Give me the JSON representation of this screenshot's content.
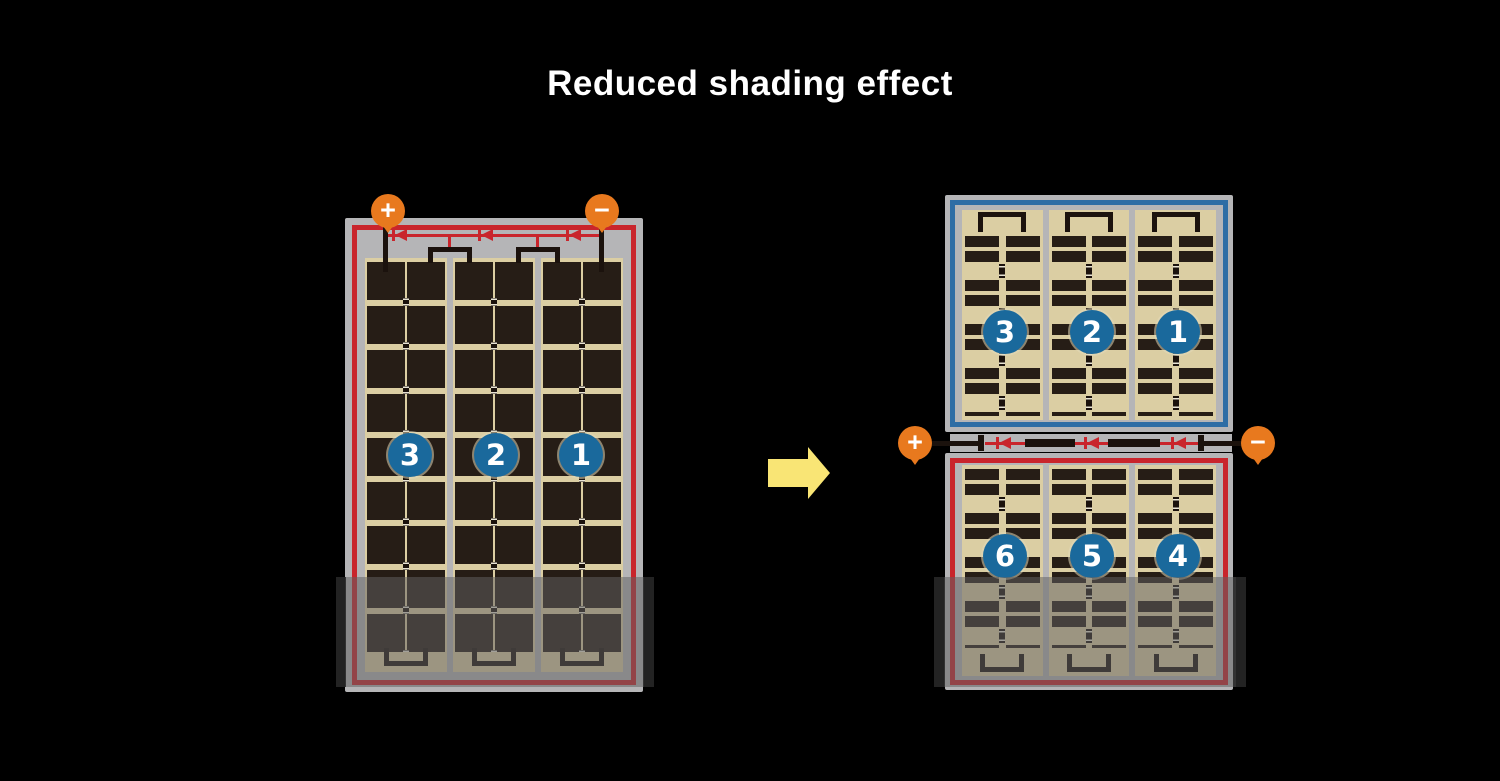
{
  "title": "Reduced shading effect",
  "colors": {
    "background": "#000000",
    "frame_gray": "#b5b5b7",
    "cell_tan": "#dbcea3",
    "cell_dark": "#261d16",
    "wire_black": "#1b120d",
    "red_accent": "#c9252c",
    "blue_accent": "#2e6da5",
    "circle_blue": "#1a699c",
    "terminal_orange": "#e8791e",
    "arrow_yellow": "#f9e575"
  },
  "full_panel": {
    "terminals": {
      "positive": "+",
      "negative": "−"
    },
    "cell_groups": [
      "3",
      "2",
      "1"
    ],
    "bypass_diode_count": 3
  },
  "half_cut_panel": {
    "terminals": {
      "positive": "+",
      "negative": "−"
    },
    "top_cell_groups": [
      "3",
      "2",
      "1"
    ],
    "bottom_cell_groups": [
      "6",
      "5",
      "4"
    ],
    "bypass_diode_count": 3
  }
}
